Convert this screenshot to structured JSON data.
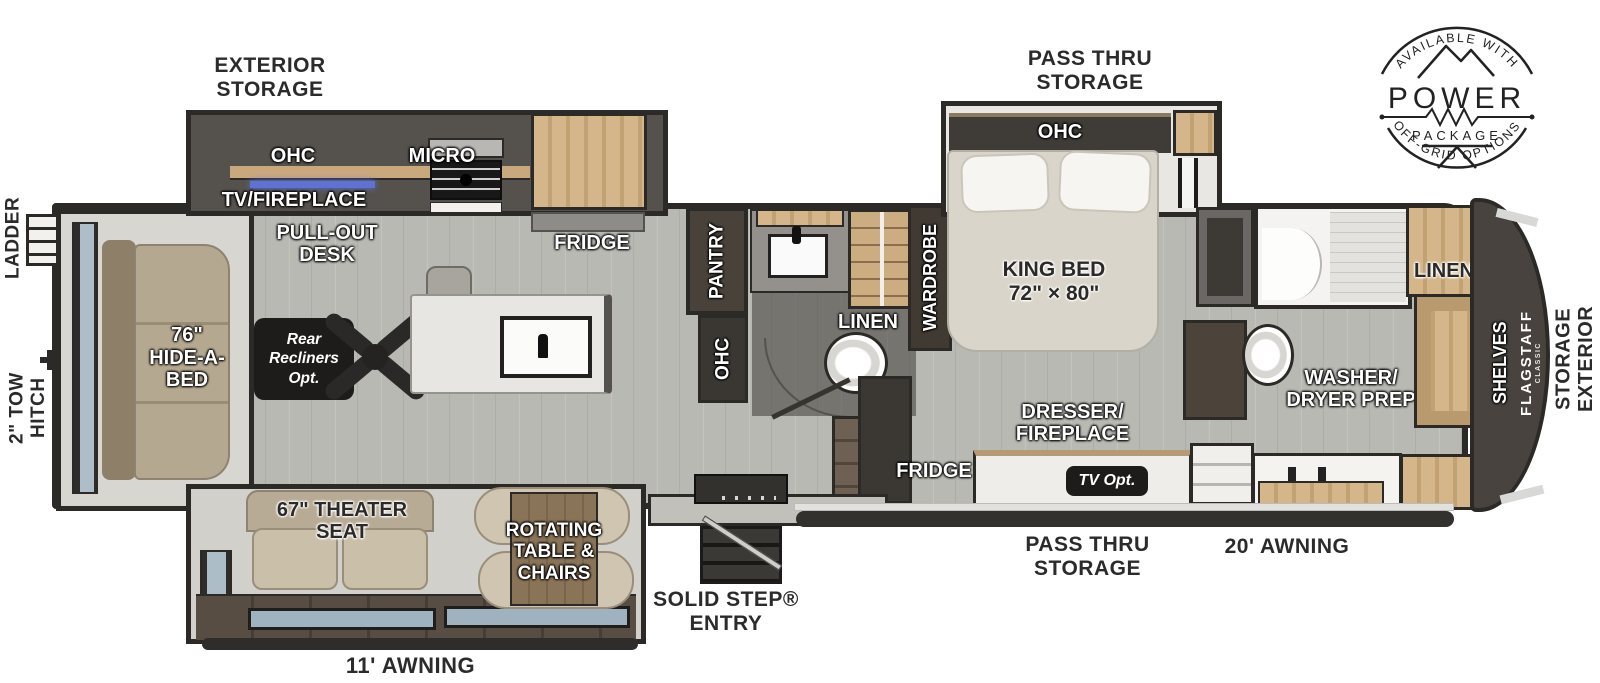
{
  "badge": {
    "arc_top": "AVAILABLE WITH",
    "title": "POWER",
    "subtitle": "PACKAGE",
    "arc_bottom": "OFF-GRID OPTIONS"
  },
  "exterior": {
    "storage_top": "EXTERIOR\nSTORAGE",
    "pass_thru_top": "PASS THRU\nSTORAGE",
    "ladder": "LADDER",
    "tow_hitch": "2\" TOW\nHITCH",
    "awning_11": "11' AWNING",
    "solid_step": "SOLID STEP®\nENTRY",
    "pass_thru_bottom": "PASS THRU\nSTORAGE",
    "awning_20": "20' AWNING",
    "storage_right": "EXTERIOR\nSTORAGE"
  },
  "kitchen": {
    "ohc": "OHC",
    "micro": "MICRO",
    "tv_fireplace": "TV/FIREPLACE",
    "pull_out_desk": "PULL-OUT\nDESK",
    "fridge": "FRIDGE"
  },
  "living": {
    "hide_a_bed": "76\"\nHIDE-A-\nBED",
    "rear_recliners": "Rear\nRecliners\nOpt.",
    "theater_seat": "67\" THEATER\nSEAT",
    "rotating_table": "ROTATING\nTABLE &\nCHAIRS"
  },
  "mid_bath": {
    "pantry": "PANTRY",
    "ohc": "OHC",
    "linen": "LINEN"
  },
  "bedroom": {
    "ohc": "OHC",
    "wardrobe": "WARDROBE",
    "king_bed": "KING BED\n72\" × 80\"",
    "dresser_fireplace": "DRESSER/\nFIREPLACE",
    "tv_opt": "TV Opt.",
    "fridge": "FRIDGE"
  },
  "front_bath": {
    "linen": "LINEN",
    "washer_dryer": "WASHER/\nDRYER PREP"
  },
  "front_cap": {
    "shelves": "SHELVES",
    "brand": "FLAGSTAFF",
    "brand_sub": "CLASSIC"
  },
  "colors": {
    "floor": "#b8b9b2",
    "wall": "#2c2a27",
    "wood": "#c9ab80",
    "dark_cabinet": "#3f3c38",
    "badge_ink": "#222222",
    "label_white": "#ffffff",
    "label_dark": "#2b2a28",
    "led_accent": "#5e72d6"
  }
}
